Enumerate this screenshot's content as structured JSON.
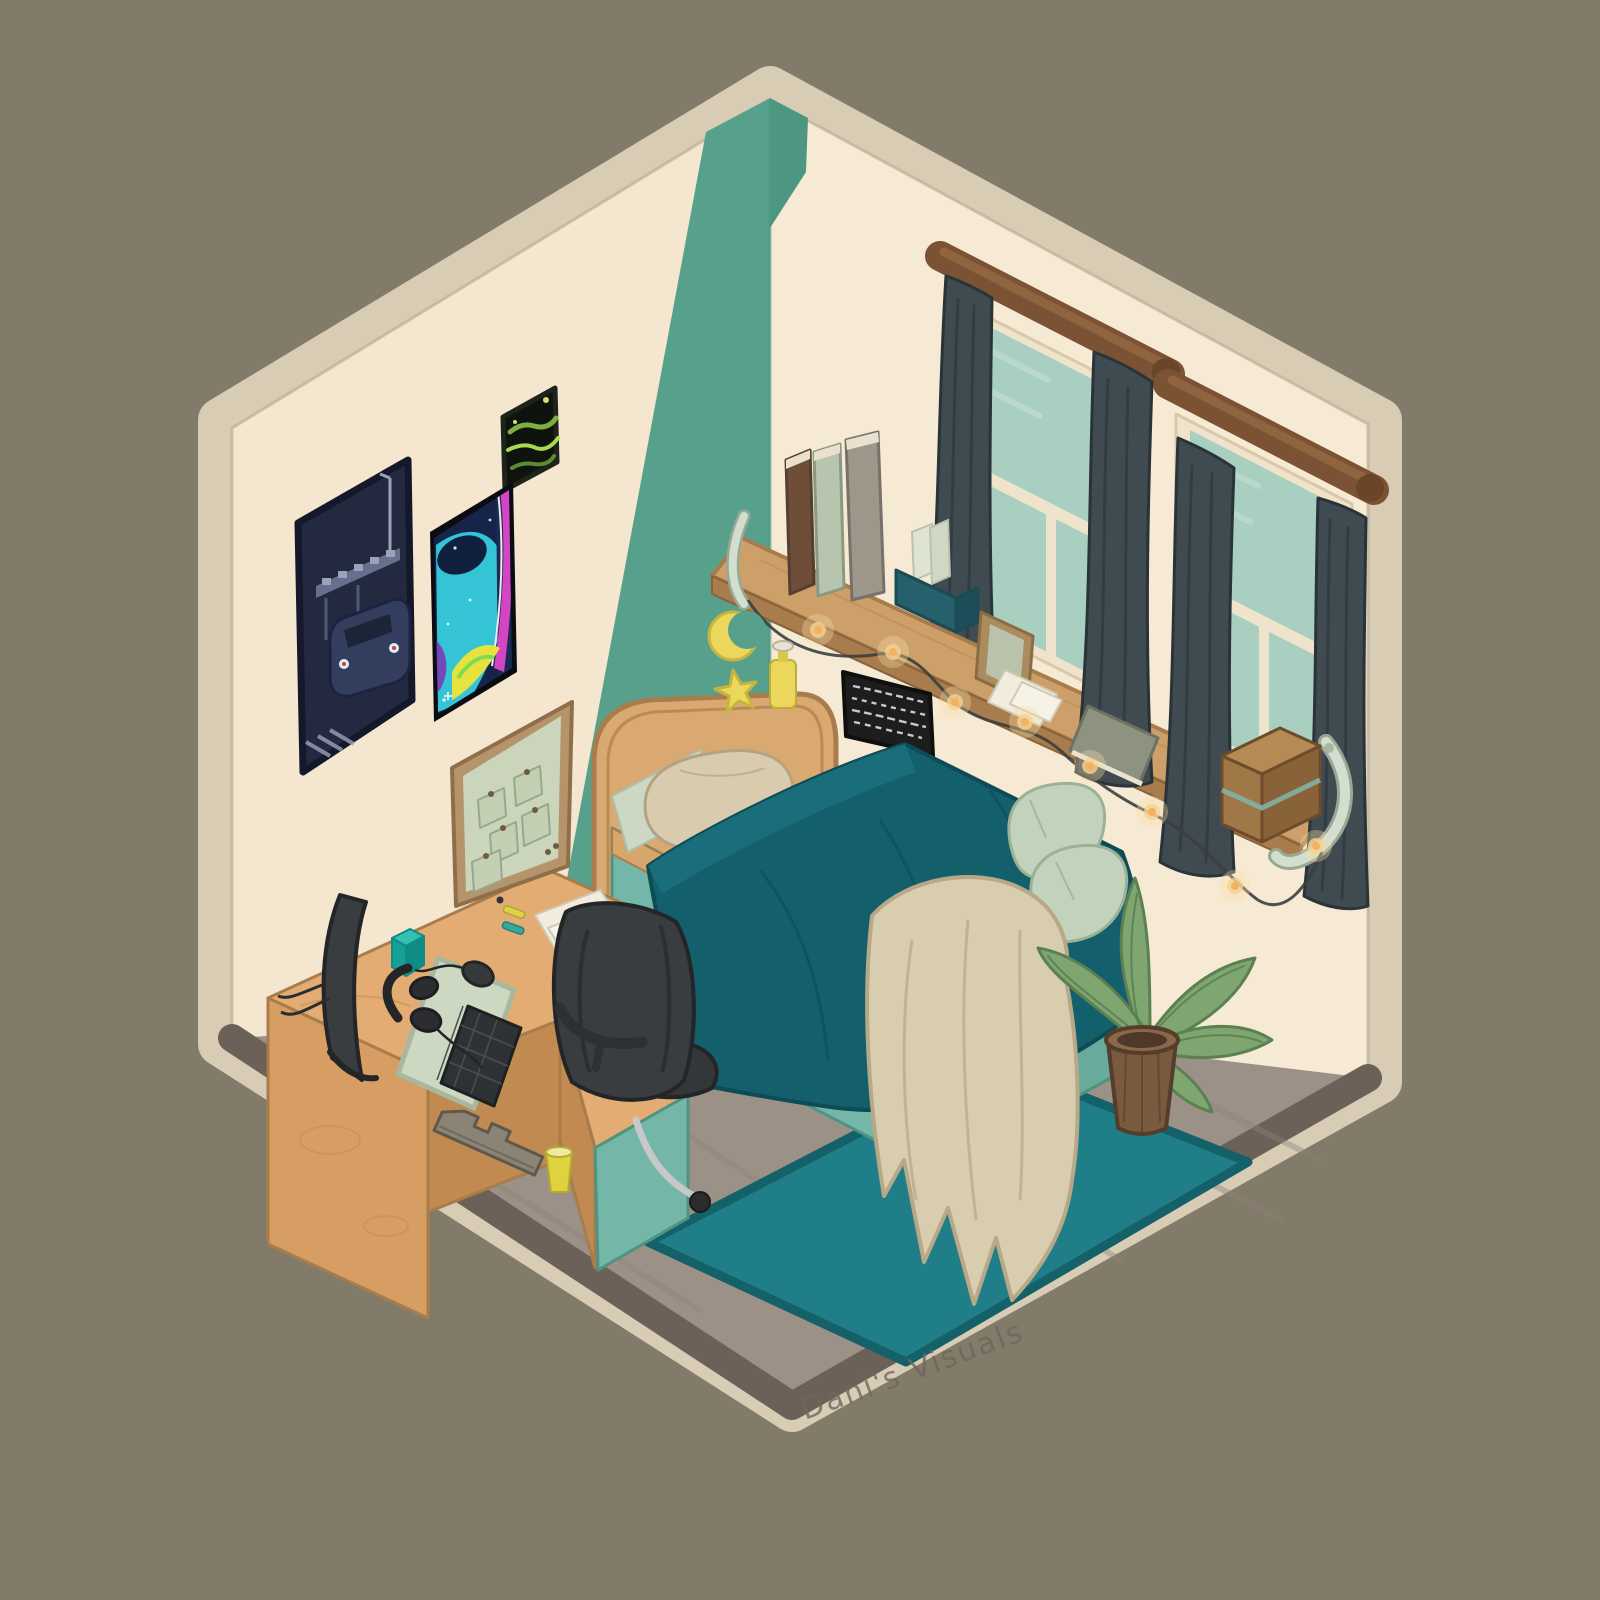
{
  "meta": {
    "kind": "digital illustration",
    "scene": "isometric bedroom cutaway"
  },
  "signature": {
    "text": "Dani's Visuals"
  },
  "scene": {
    "objects": [
      "left wall with car poster, green abstract poster, neon thermal poster",
      "teal corner accent stripe with moon and star decals",
      "right wall with two curtained windows, black plaque, long wood shelf",
      "shelf items: three books, teal letter box, photo frame, papers, flat book, wooden box",
      "string lights draped under shelf",
      "bed with wood headboard, teal duvet, beige pillow, sage throw pillows, beige knit blanket, under-bed drawers",
      "L-shaped wood desk with curved monitor, headphones, mousepad, keyboard, mouse, teal cube, gray stand, yellow cup, papers, pens, bulletin board",
      "black office chair",
      "teal area rug",
      "potted plant",
      "yellow lotion bottle on headboard"
    ]
  },
  "palette": {
    "bg": "#837b6a",
    "trim": "#d8ccb5",
    "trim_line": "#bfb199",
    "wall_left": "#f4e6cf",
    "wall_right": "#f7ead4",
    "accent_teal": "#57a18c",
    "accent_teal_dark": "#4d9681",
    "floor": "#9c9187",
    "floor_grain": "#8d8279",
    "floor_edge": "#6b6158",
    "rug": "#1f7e88",
    "rug_edge": "#14616a",
    "wood_top": "#e3ac72",
    "wood_front": "#d79e63",
    "wood_side": "#c08a50",
    "wood_outline": "#a87c4b",
    "shelf_top": "#cda069",
    "shelf_front": "#a87c4c",
    "headboard": "#daa972",
    "bed_rail": "#d7a66c",
    "duvet": "#135f6b",
    "duvet_dark": "#0d4b55",
    "duvet_roll": "#1a6e7c",
    "underbed": "#74b7a9",
    "underbed_dark": "#4f9381",
    "underbed_side": "#68aa9c",
    "sheet": "#ccd8c3",
    "pillow_beige": "#d9ccae",
    "pillow_beige_line": "#b3a384",
    "pillow_sage": "#c3d2bc",
    "pillow_sage_line": "#9cb297",
    "blanket": "#d8cdae",
    "blanket_line": "#b7a887",
    "curtain": "#3f4a51",
    "curtain_dark": "#2f383e",
    "curtain_edge": "#2a3338",
    "rod": "#7b5233",
    "rod_light": "#916440",
    "rod_cap": "#6a4528",
    "glass": "#a9cfc1",
    "glass_light": "#c2ded2",
    "window_frame": "#efe3cb",
    "window_frame_line": "#d9c8aa",
    "monitor_gray": "#3a3d40",
    "outline_gray": "#232527",
    "mousepad": "#ccd8c1",
    "mousepad_line": "#a9b79e",
    "keyboard": "#2f3234",
    "key_line": "#4a4e52",
    "stand_gray": "#8b8476",
    "stand_gray_dark": "#5f594d",
    "cup_yellow": "#ded23f",
    "cup_yellow_light": "#efe9a6",
    "pen_yellow": "#e0d145",
    "pen_teal": "#38a69a",
    "cube_teal": "#15a096",
    "cube_teal_light": "#35c0b3",
    "cube_teal_dark": "#0f8c86",
    "deco_yellow": "#ead75c",
    "deco_yellow_line": "#c7b43e",
    "bottle_cap": "#e8e2d2",
    "board_frame": "#b5946c",
    "board_frame_line": "#8f6f49",
    "board_face": "#cbd5bb",
    "note_fill": "#c3cfb2",
    "note_line": "#97a88c",
    "pin": "#6e5b43",
    "paper": "#f1ecdd",
    "paper_line": "#cfc8b4",
    "plant_green": "#7fa571",
    "plant_green_dark": "#5b8052",
    "plant_vein": "#567c4e",
    "pot_brown": "#7a5a3e",
    "pot_rim": "#8a6848",
    "pot_dark": "#543d2a",
    "poster_navy": "#232a40",
    "poster_navy_dark": "#14182a",
    "poster_gray_blue": "#6a7490",
    "poster_light": "#9aa3b8",
    "neon_bg": "#16244a",
    "neon_cyan": "#35c3d6",
    "neon_navy": "#12203f",
    "neon_magenta": "#d445c4",
    "neon_yellow": "#e8e23f",
    "neon_purple": "#7a3bb5",
    "green_poster_bg": "#0e130d",
    "green1": "#7fae3e",
    "green2": "#a8d94e",
    "green3": "#5b8c33",
    "green_dot": "#d6e06a",
    "book_brown": "#6e4e39",
    "book_sage": "#b7c4ae",
    "book_taupe": "#9d978a",
    "pages": "#e9e1cd",
    "box_teal": "#26606c",
    "box_teal_dark": "#1c4a55",
    "frame_wood": "#ab8c5e",
    "photo_sage": "#b9c2ab",
    "flatbook": "#8e9281",
    "woodbox": "#a07848",
    "woodbox_side": "#8a6239",
    "woodbox_top": "#b58a55",
    "woodbox_trim": "#7fb2a4",
    "bracket": "#d3dfce",
    "bracket_line": "#9aa795",
    "light_string": "#3a3f3f",
    "glow_outer": "#f6dca6",
    "glow_core": "#f3b25f",
    "plaque": "#1d1d1d",
    "scribble": "#e8e8e8",
    "chair_base": "#c8c8c8",
    "signature": "#6f675c"
  }
}
